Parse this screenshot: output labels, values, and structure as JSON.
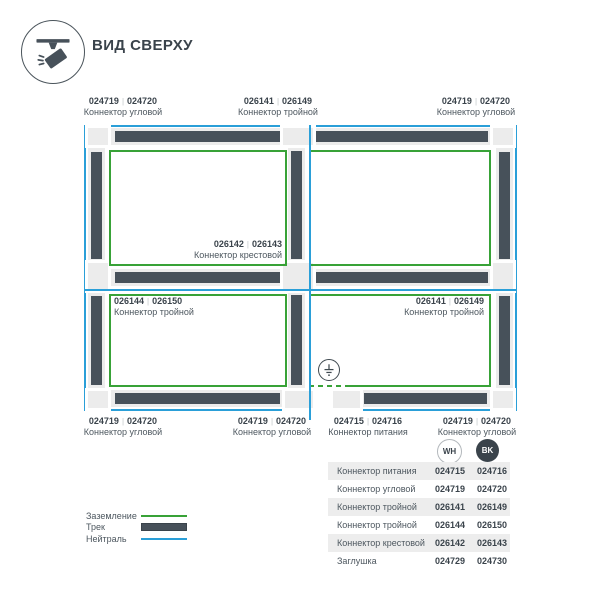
{
  "header": {
    "title": "ВИД СВЕРХУ"
  },
  "separator": "|",
  "colors": {
    "blue": "#2a9fd8",
    "green": "#38a237",
    "track": "#47515a",
    "band": "#ececec",
    "ink": "#3a434b",
    "muted": "#4d575f"
  },
  "top_labels": [
    {
      "code_wh": "024719",
      "code_bk": "024720",
      "name": "Коннектор угловой"
    },
    {
      "code_wh": "026141",
      "code_bk": "026149",
      "name": "Коннектор тройной"
    },
    {
      "code_wh": "024719",
      "code_bk": "024720",
      "name": "Коннектор угловой"
    }
  ],
  "inner_labels": [
    {
      "code_wh": "026142",
      "code_bk": "026143",
      "name": "Коннектор крестовой"
    },
    {
      "code_wh": "026144",
      "code_bk": "026150",
      "name": "Коннектор тройной"
    },
    {
      "code_wh": "026141",
      "code_bk": "026149",
      "name": "Коннектор тройной"
    }
  ],
  "bottom_labels": [
    {
      "code_wh": "024719",
      "code_bk": "024720",
      "name": "Коннектор угловой"
    },
    {
      "code_wh": "024719",
      "code_bk": "024720",
      "name": "Коннектор угловой"
    },
    {
      "code_wh": "024715",
      "code_bk": "024716",
      "name": "Коннектор питания"
    },
    {
      "code_wh": "024719",
      "code_bk": "024720",
      "name": "Коннектор угловой"
    }
  ],
  "color_columns": [
    {
      "label": "WH"
    },
    {
      "label": "BK"
    }
  ],
  "table": {
    "rows": [
      {
        "name": "Коннектор питания",
        "wh": "024715",
        "bk": "024716"
      },
      {
        "name": "Коннектор угловой",
        "wh": "024719",
        "bk": "024720"
      },
      {
        "name": "Коннектор тройной",
        "wh": "026141",
        "bk": "026149"
      },
      {
        "name": "Коннектор тройной",
        "wh": "026144",
        "bk": "026150"
      },
      {
        "name": "Коннектор крестовой",
        "wh": "026142",
        "bk": "026143"
      },
      {
        "name": "Заглушка",
        "wh": "024729",
        "bk": "024730"
      }
    ]
  },
  "legend": [
    {
      "label": "Заземление",
      "color": "#38a237",
      "style": "line"
    },
    {
      "label": "Трек",
      "color": "#47515a",
      "style": "bar"
    },
    {
      "label": "Нейтраль",
      "color": "#2a9fd8",
      "style": "line"
    }
  ]
}
